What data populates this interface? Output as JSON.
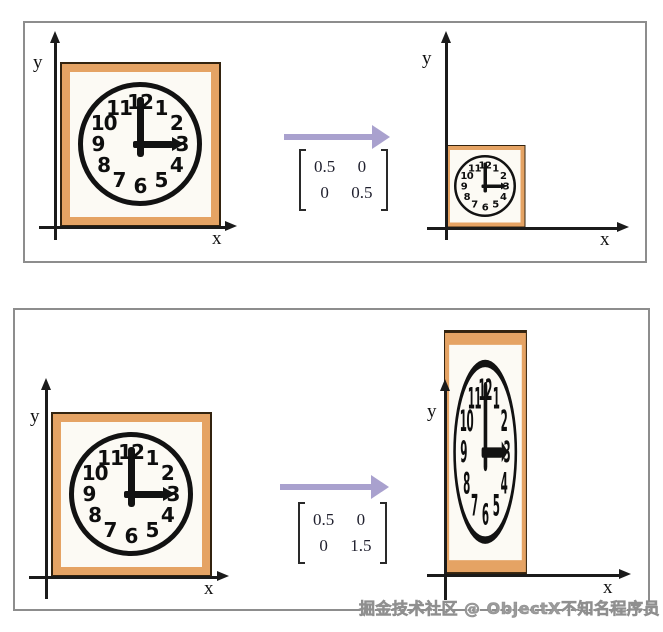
{
  "page": {
    "watermark": "掘金技术社区 @ ObjectX不知名程序员"
  },
  "colors": {
    "frame": "#E5A364",
    "arrow": "#A9A1CE",
    "ink": "#1b1b1b",
    "panel_border": "#8d8d8d",
    "clock_face": "#fcfaf4"
  },
  "clock": {
    "numerals": [
      "12",
      "1",
      "2",
      "3",
      "4",
      "5",
      "6",
      "7",
      "8",
      "9",
      "10",
      "11"
    ],
    "time": "3:00"
  },
  "panels": [
    {
      "name": "uniform-scaling",
      "left_graph": {
        "x_label": "x",
        "y_label": "y"
      },
      "right_graph": {
        "x_label": "x",
        "y_label": "y"
      },
      "matrix": [
        [
          "0.5",
          "0"
        ],
        [
          "0",
          "0.5"
        ]
      ]
    },
    {
      "name": "nonuniform-scaling",
      "left_graph": {
        "x_label": "x",
        "y_label": "y"
      },
      "right_graph": {
        "x_label": "x",
        "y_label": "y"
      },
      "matrix": [
        [
          "0.5",
          "0"
        ],
        [
          "0",
          "1.5"
        ]
      ]
    }
  ]
}
